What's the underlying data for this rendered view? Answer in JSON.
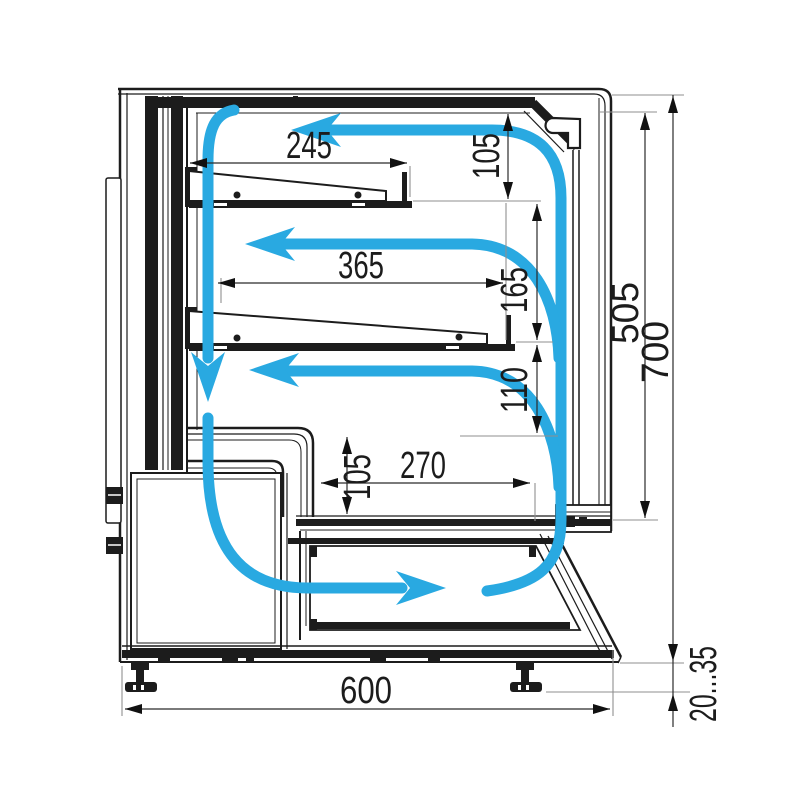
{
  "diagram": {
    "title": "Refrigerated display case cross-section with air circulation",
    "airflow_color": "#29a9e1",
    "line_color": "#1c1c1c"
  },
  "dims": {
    "shelf1_depth": "245",
    "top_gap": "105",
    "shelf2_depth": "365",
    "shelf_gap": "165",
    "lower_gap": "110",
    "well_height": "105",
    "well_depth": "270",
    "glass_height": "505",
    "total_height": "700",
    "total_depth": "600",
    "leg_range": "20...35"
  }
}
